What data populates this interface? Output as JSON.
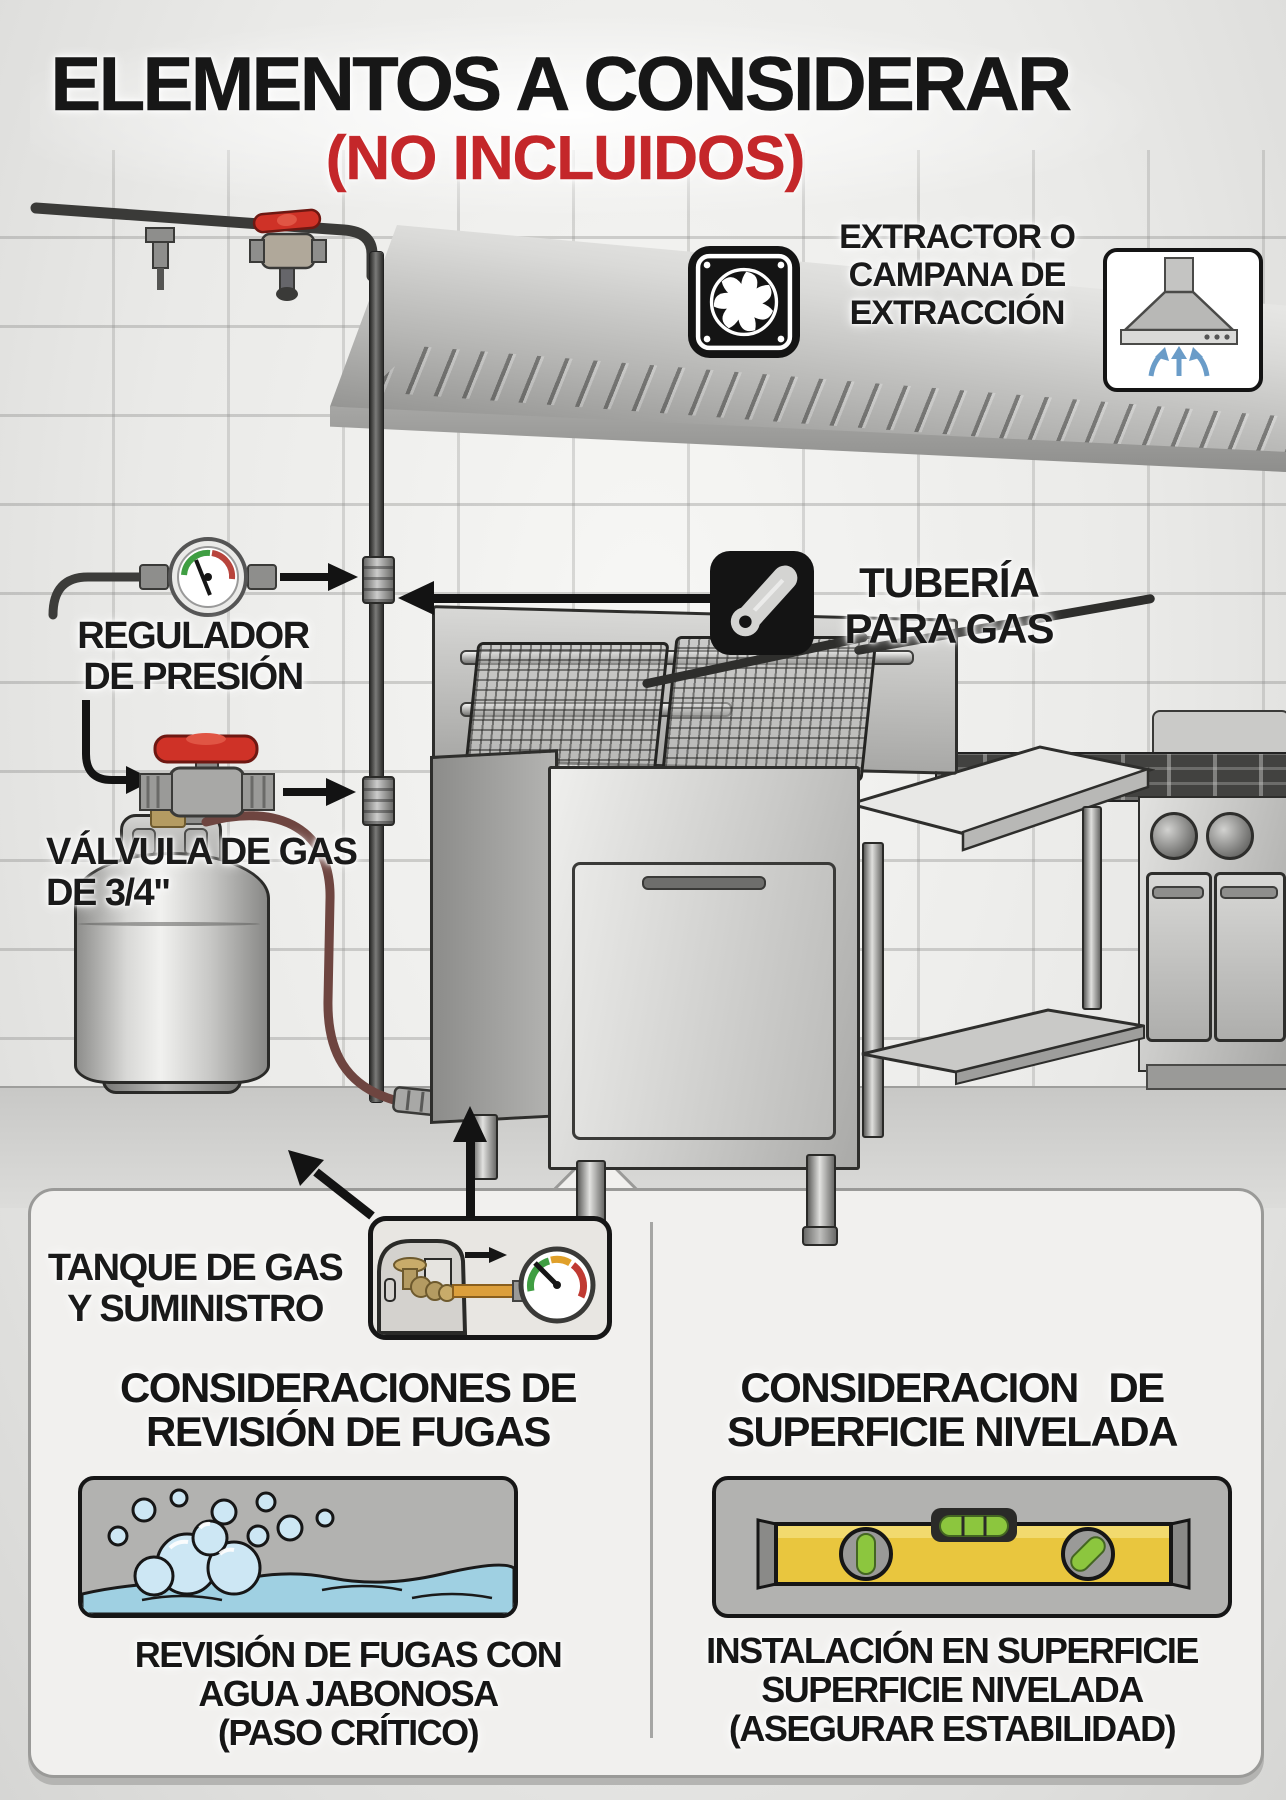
{
  "title": {
    "line1": "ELEMENTOS A CONSIDERAR",
    "line2": "(NO INCLUIDOS)"
  },
  "callouts": {
    "extractor": "EXTRACTOR O\nCAMPANA DE\nEXTRACCIÓN",
    "gas_pipe": "TUBERÍA\nPARA GAS",
    "pressure_regulator": "REGULADOR\nDE PRESIÓN",
    "gas_valve": "VÁLVULA DE GAS\nDE 3/4\"",
    "gas_tank": "TANQUE DE GAS\nY SUMINISTRO"
  },
  "panels": {
    "leak_check": {
      "heading": "CONSIDERACIONES DE\nREVISIÓN DE FUGAS",
      "caption": "REVISIÓN DE FUGAS CON\nAGUA JABONOSA\n(PASO CRÍTICO)"
    },
    "level_surface": {
      "heading": "CONSIDERACION   DE\nSUPERFICIE NIVELADA",
      "caption": "INSTALACIÓN EN SUPERFICIE\nSUPERFICIE NIVELADA\n(ASEGURAR ESTABILIDAD)"
    }
  },
  "icons": {
    "fan-icon": "✺",
    "extraction-hood-icon": "⬒ with ↑↑↑",
    "gas-pipe-icon": "⌀ diagonal cylinder",
    "pressure-gauge-icon": "◔",
    "gas-valve-icon": "✚ red tee handle",
    "tank-gauge-inset-icon": "tank + ◔",
    "soapy-water-icon": "bubbles over waves",
    "spirit-level-icon": "yellow level with vials",
    "left-arrow": "←",
    "right-arrow": "→",
    "up-arrow": "↑"
  },
  "colors": {
    "title_black": "#171717",
    "accent_red": "#c4272a",
    "icon_tile_black": "#141414",
    "arrow_black": "#131313",
    "hood_arrow_blue": "#6a9cc8",
    "valve_handle_red": "#cf3227",
    "gauge_green": "#3f9e42",
    "gauge_yellow": "#e0a02a",
    "gauge_red": "#c03a32",
    "level_yellow": "#e9c63e",
    "bubble_blue": "#cde7f4",
    "water_blue": "#9fd0e2",
    "hose_brown": "#6e4540",
    "brass": "#b49b62"
  }
}
